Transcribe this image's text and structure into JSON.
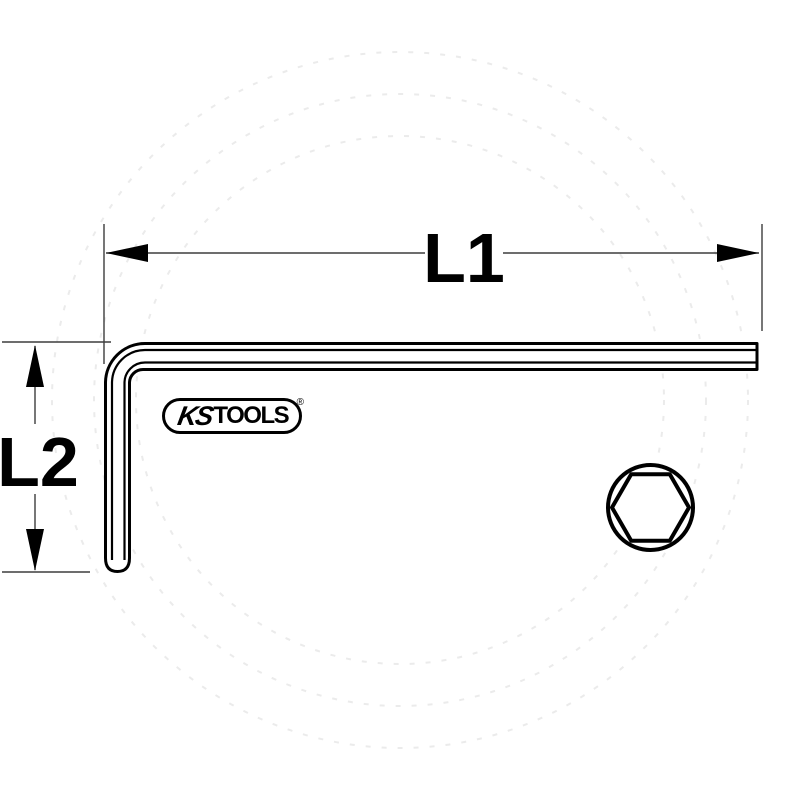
{
  "diagram": {
    "description": "technical-line-drawing-of-L-shaped-hex-key-with-dimensions",
    "dimension_labels": {
      "l1": "L1",
      "l2": "L2"
    },
    "logo": {
      "ks": "KS",
      "tools": "TOOLS",
      "registered": "®"
    },
    "colors": {
      "background": "#ffffff",
      "outline": "#000000",
      "dimension_line": "#3d3d3d",
      "watermark": "#ebebeb"
    }
  }
}
